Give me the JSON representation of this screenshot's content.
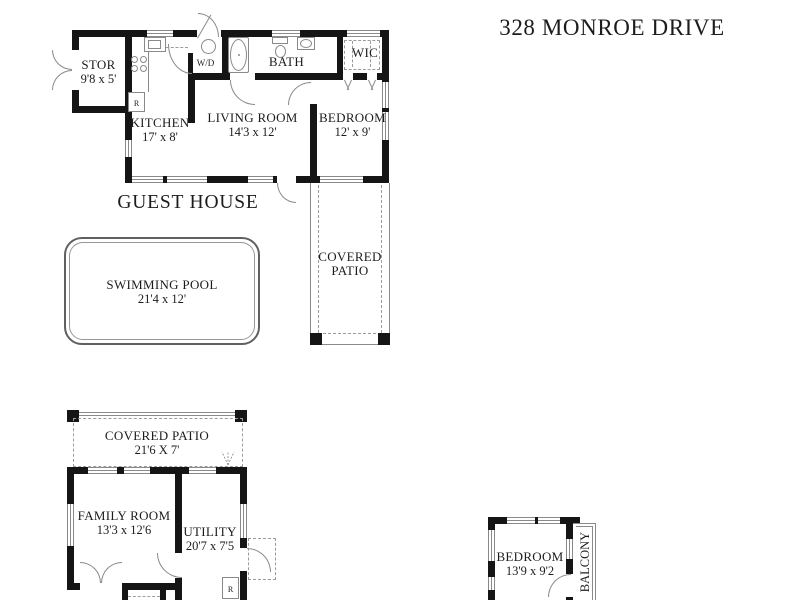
{
  "title": "328 MONROE DRIVE",
  "guest_house": {
    "label": "GUEST HOUSE",
    "stor": {
      "name": "STOR",
      "dims": "9'8 x 5'"
    },
    "kitchen": {
      "name": "KITCHEN",
      "dims": "17' x 8'"
    },
    "living_room": {
      "name": "LIVING ROOM",
      "dims": "14'3 x 12'"
    },
    "bath": {
      "name": "BATH"
    },
    "wic": {
      "name": "WIC"
    },
    "bedroom": {
      "name": "BEDROOM",
      "dims": "12' x 9'"
    },
    "washer_dryer": "W/D",
    "refrigerator": "R"
  },
  "site": {
    "pool": {
      "name": "SWIMMING POOL",
      "dims": "21'4 x 12'"
    },
    "covered_patio": {
      "line1": "COVERED",
      "line2": "PATIO"
    }
  },
  "main_house": {
    "covered_patio": {
      "name": "COVERED PATIO",
      "dims": "21'6 X 7'"
    },
    "family_room": {
      "name": "FAMILY ROOM",
      "dims": "13'3 x 12'6"
    },
    "utility": {
      "name": "UTILITY",
      "dims": "20'7 x 7'5"
    },
    "refrigerator": "R",
    "bedroom": {
      "name": "BEDROOM",
      "dims": "13'9 x 9'2"
    },
    "balcony": "BALCONY"
  },
  "colors": {
    "wall": "#151515",
    "line": "#8a8a8a",
    "dash": "#9b9b9b",
    "text": "#1c1c1c",
    "background": "#ffffff"
  }
}
